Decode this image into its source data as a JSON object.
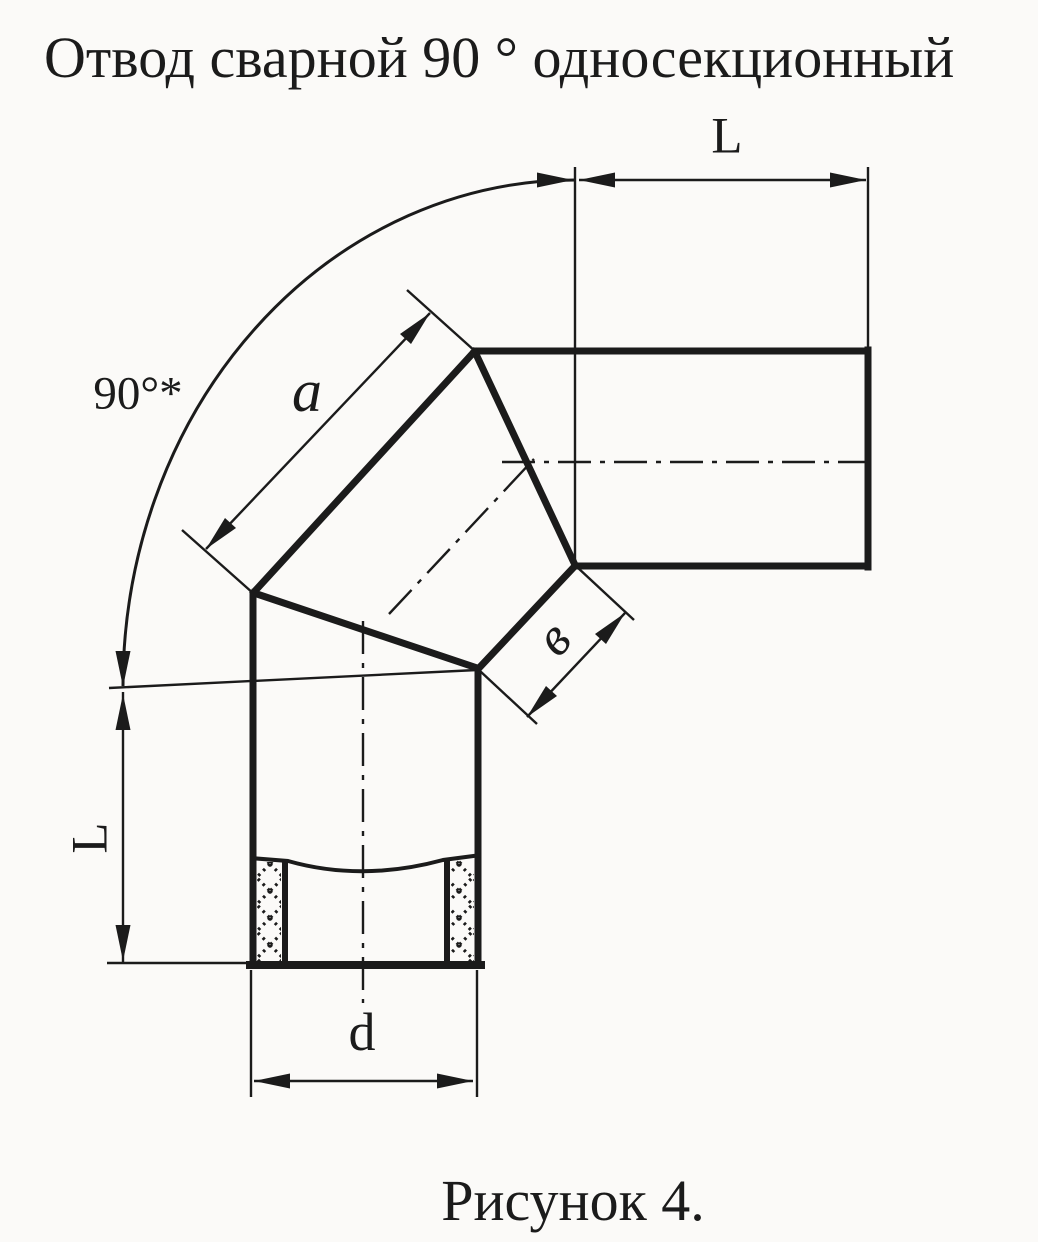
{
  "title": "Отвод сварной 90 ° односекционный",
  "caption": "Рисунок 4.",
  "labels": {
    "angle": "90°*",
    "top_length": "L",
    "side_length": "L",
    "outer_segment": "a",
    "inner_segment": "в",
    "diameter": "d"
  },
  "drawing": {
    "type": "technical-drawing",
    "subject": "welded 90-degree single-section pipe elbow, sectional view",
    "dimension_annotations": [
      {
        "label": "L",
        "measures": "horizontal branch length (top)"
      },
      {
        "label": "L",
        "measures": "vertical branch length (left)"
      },
      {
        "label": "90°*",
        "measures": "elbow angle arc"
      },
      {
        "label": "a",
        "measures": "outer edge of middle miter section"
      },
      {
        "label": "в",
        "measures": "inner edge width of middle miter section"
      },
      {
        "label": "d",
        "measures": "pipe bore diameter (bottom)"
      }
    ]
  },
  "colors": {
    "ink": "#1b1b1b",
    "paper": "#fbfaf8"
  }
}
